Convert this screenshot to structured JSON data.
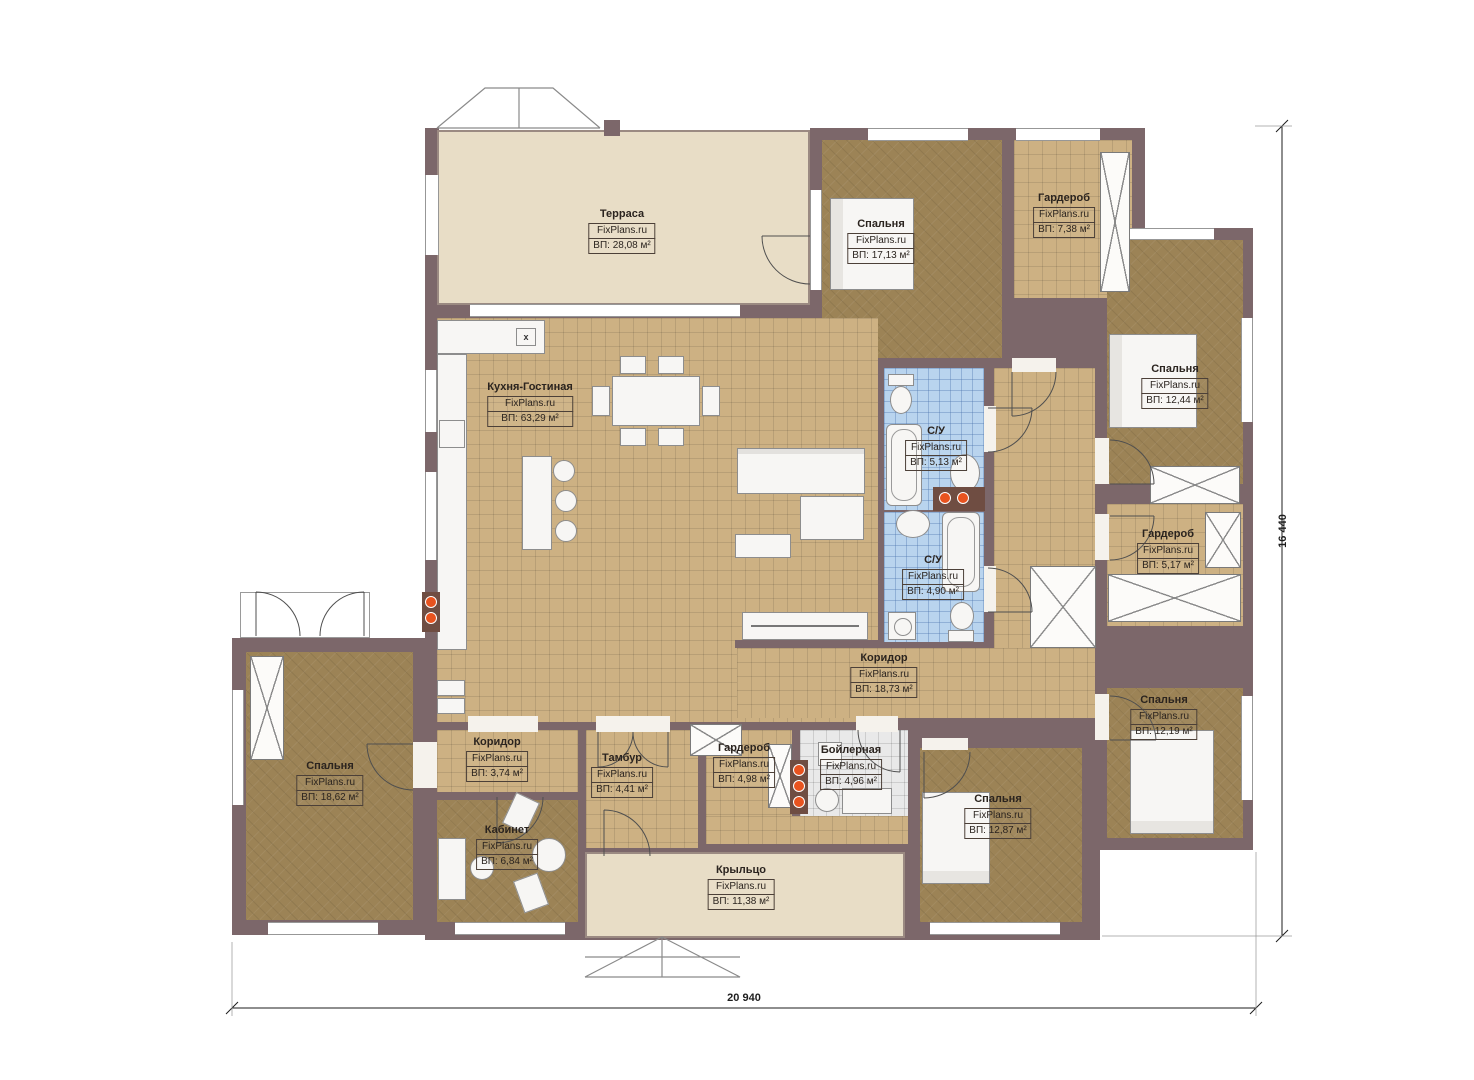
{
  "watermark": "FixPlans.ru",
  "dimensions": {
    "bottom": "20 940",
    "right": "16 440"
  },
  "icons": {
    "hob_label": "x"
  },
  "colors": {
    "wall": "#7c676a",
    "tile_floor": "#cdb183",
    "bedroom_floor": "#9c8356",
    "bath_floor": "#b9d4ee",
    "terrace_floor": "#e8ddc6",
    "accent_dot": "#e8531f"
  },
  "rooms": [
    {
      "id": "terrace",
      "name": "Терраса",
      "area": "ВП: 28,08 м²"
    },
    {
      "id": "bedroom-top",
      "name": "Спальня",
      "area": "ВП: 17,13 м²"
    },
    {
      "id": "wardrobe-top",
      "name": "Гардероб",
      "area": "ВП: 7,38 м²"
    },
    {
      "id": "bedroom-right-1",
      "name": "Спальня",
      "area": "ВП: 12,44 м²"
    },
    {
      "id": "kitchen-living",
      "name": "Кухня-Гостиная",
      "area": "ВП: 63,29 м²"
    },
    {
      "id": "bath-1",
      "name": "С/У",
      "area": "ВП: 5,13 м²"
    },
    {
      "id": "bath-2",
      "name": "С/У",
      "area": "ВП: 4,90 м²"
    },
    {
      "id": "wardrobe-right",
      "name": "Гардероб",
      "area": "ВП: 5,17 м²"
    },
    {
      "id": "corridor-main",
      "name": "Коридор",
      "area": "ВП: 18,73 м²"
    },
    {
      "id": "bedroom-right-2",
      "name": "Спальня",
      "area": "ВП: 12,19 м²"
    },
    {
      "id": "bedroom-left",
      "name": "Спальня",
      "area": "ВП: 18,62 м²"
    },
    {
      "id": "corridor-small",
      "name": "Коридор",
      "area": "ВП: 3,74 м²"
    },
    {
      "id": "tambour",
      "name": "Тамбур",
      "area": "ВП: 4,41 м²"
    },
    {
      "id": "wardrobe-bottom",
      "name": "Гардероб",
      "area": "ВП: 4,98 м²"
    },
    {
      "id": "boiler",
      "name": "Бойлерная",
      "area": "ВП: 4,96 м²"
    },
    {
      "id": "office",
      "name": "Кабинет",
      "area": "ВП: 6,84 м²"
    },
    {
      "id": "bedroom-bottom",
      "name": "Спальня",
      "area": "ВП: 12,87 м²"
    },
    {
      "id": "porch",
      "name": "Крыльцо",
      "area": "ВП: 11,38 м²"
    }
  ]
}
